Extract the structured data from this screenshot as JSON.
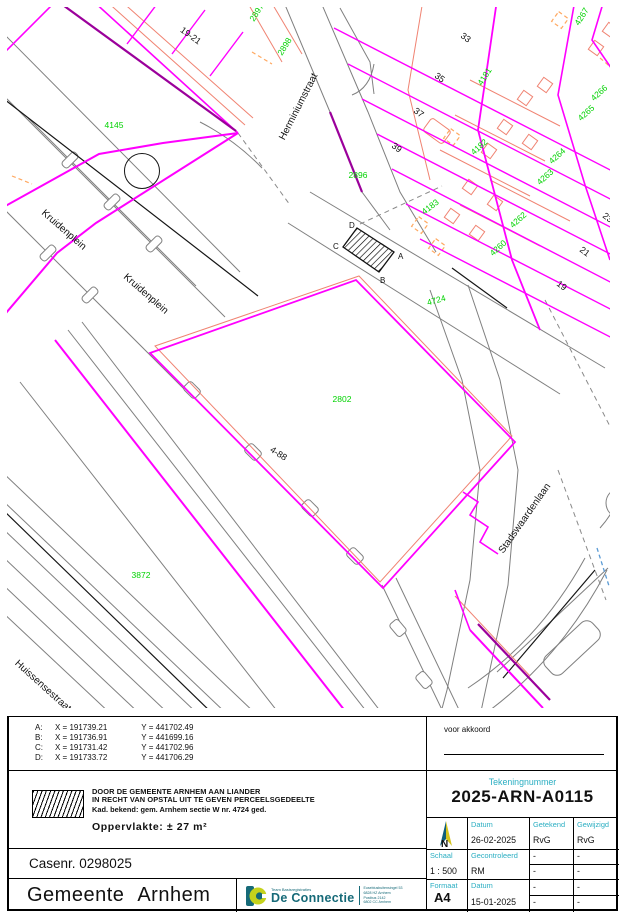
{
  "map": {
    "streets": [
      "Herminiumstraat",
      "Kruidenplein",
      "Kruidenplein",
      "Huissensestraat",
      "Stadswaardenlaan"
    ],
    "house_numbers": [
      "19-21",
      "33",
      "35",
      "37",
      "39",
      "25",
      "23",
      "21",
      "19",
      "4-88"
    ],
    "parcels": [
      "4145",
      "2897",
      "2898",
      "2896",
      "4181",
      "4182",
      "4183",
      "4267",
      "4266",
      "4265",
      "4264",
      "4263",
      "4262",
      "4260",
      "4724",
      "2802",
      "3872"
    ],
    "corners": [
      "A",
      "B",
      "C",
      "D"
    ]
  },
  "coordinates": {
    "rows": [
      {
        "id": "A:",
        "x": "X = 191739.21",
        "y": "Y = 441702.49"
      },
      {
        "id": "B:",
        "x": "X = 191736.91",
        "y": "Y = 441699.16"
      },
      {
        "id": "C:",
        "x": "X = 191731.42",
        "y": "Y = 441702.96"
      },
      {
        "id": "D:",
        "x": "X = 191733.72",
        "y": "Y = 441706.29"
      }
    ]
  },
  "approval": {
    "label": "voor akkoord"
  },
  "legend": {
    "line1": "DOOR DE GEMEENTE ARNHEM AAN LIANDER",
    "line2": "IN RECHT VAN OPSTAL UIT TE GEVEN PERCEELSGEDEELTE",
    "line3": "Kad. bekend: gem. Arnhem sectie W nr. 4724 ged.",
    "area": "Oppervlakte: ± 27 m²"
  },
  "case_number": "Casenr. 0298025",
  "municipality": "Gemeente Arnhem",
  "logo": {
    "team": "Team Basisregistraties",
    "name": "De Connectie",
    "address1": "Eusebiusbuitensingel 53",
    "address2": "6828 HZ Arnhem",
    "address3": "Postbus 2142",
    "address4": "6802 CC Arnhem"
  },
  "titleblock": {
    "drawing_number_label": "Tekeningnummer",
    "drawing_number": "2025-ARN-A0115",
    "north": "N",
    "getekend_label": "Getekend",
    "getekend": "RvG",
    "gewijzigd_label": "Gewijzigd",
    "gewijzigd": "RvG",
    "datum1_label": "Datum",
    "datum1": "26-02-2025",
    "schaal_label": "Schaal",
    "schaal": "1 : 500",
    "gecontroleerd_label": "Gecontroleerd",
    "gecontroleerd": "RM",
    "formaat_label": "Formaat",
    "formaat": "A4",
    "datum2_label": "Datum",
    "datum2": "15-01-2025",
    "dash": "-"
  },
  "colors": {
    "parcel_magenta": "#ff00ff",
    "parcel_purple": "#9b009b",
    "building_salmon": "#f08372",
    "label_green": "#00d200",
    "accent_cyan": "#2aaec2",
    "dashed_blue": "#5b9bd5",
    "logo_teal": "#166a78",
    "logo_yellow": "#c5d21c"
  }
}
